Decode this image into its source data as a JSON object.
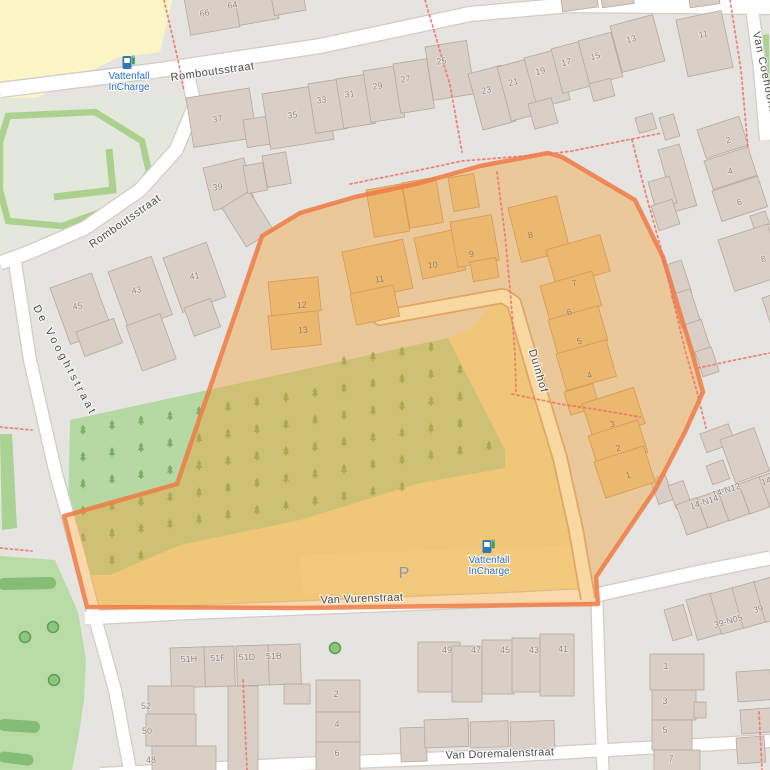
{
  "streets": [
    {
      "name": "Romboutsstraat",
      "x": 213,
      "y": 75,
      "rot": -8,
      "ls": 0.5
    },
    {
      "name": "Romboutsstraat",
      "x": 127,
      "y": 224,
      "rot": -35,
      "ls": 0.5
    },
    {
      "name": "De Vooghtstraat",
      "x": 62,
      "y": 362,
      "rot": 62,
      "ls": 3
    },
    {
      "name": "Van Vurenstraat",
      "x": 362,
      "y": 602,
      "rot": -2,
      "ls": 0.3
    },
    {
      "name": "Van Doremalenstraat",
      "x": 500,
      "y": 757,
      "rot": -2,
      "ls": 0.3
    },
    {
      "name": "Duinhof",
      "x": 535,
      "y": 372,
      "rot": 74,
      "ls": 1
    },
    {
      "name": "Van Coehoornstr",
      "x": 763,
      "y": 80,
      "rot": 78,
      "ls": 1
    }
  ],
  "house_numbers": [
    {
      "t": "66",
      "x": 205,
      "y": 16,
      "r": -10
    },
    {
      "t": "64",
      "x": 233,
      "y": 8,
      "r": -10
    },
    {
      "t": "37",
      "x": 218,
      "y": 122,
      "r": -9
    },
    {
      "t": "35",
      "x": 293,
      "y": 118,
      "r": -9
    },
    {
      "t": "33",
      "x": 322,
      "y": 103,
      "r": -9
    },
    {
      "t": "31",
      "x": 350,
      "y": 97,
      "r": -9
    },
    {
      "t": "29",
      "x": 378,
      "y": 89,
      "r": -9
    },
    {
      "t": "27",
      "x": 406,
      "y": 82,
      "r": -9
    },
    {
      "t": "25",
      "x": 442,
      "y": 64,
      "r": -9
    },
    {
      "t": "23",
      "x": 487,
      "y": 93,
      "r": -14
    },
    {
      "t": "21",
      "x": 514,
      "y": 85,
      "r": -14
    },
    {
      "t": "19",
      "x": 541,
      "y": 74,
      "r": -14
    },
    {
      "t": "17",
      "x": 567,
      "y": 65,
      "r": -14
    },
    {
      "t": "15",
      "x": 596,
      "y": 59,
      "r": -14
    },
    {
      "t": "13",
      "x": 632,
      "y": 42,
      "r": -14
    },
    {
      "t": "11",
      "x": 704,
      "y": 37,
      "r": -12
    },
    {
      "t": "39",
      "x": 218,
      "y": 190,
      "r": -8
    },
    {
      "t": "41",
      "x": 195,
      "y": 279,
      "r": -10
    },
    {
      "t": "43",
      "x": 137,
      "y": 293,
      "r": -10
    },
    {
      "t": "45",
      "x": 78,
      "y": 309,
      "r": -10
    },
    {
      "t": "2",
      "x": 729,
      "y": 143,
      "r": -15
    },
    {
      "t": "4",
      "x": 731,
      "y": 174,
      "r": -15
    },
    {
      "t": "6",
      "x": 740,
      "y": 205,
      "r": -15
    },
    {
      "t": "8",
      "x": 764,
      "y": 262,
      "r": -15
    },
    {
      "t": "14",
      "x": 767,
      "y": 484,
      "r": -18
    },
    {
      "t": "14-N12",
      "x": 727,
      "y": 493,
      "r": -18
    },
    {
      "t": "14-N14",
      "x": 705,
      "y": 505,
      "r": -18
    },
    {
      "t": "39",
      "x": 759,
      "y": 612,
      "r": -16
    },
    {
      "t": "39-N05",
      "x": 729,
      "y": 624,
      "r": -16
    },
    {
      "t": "1",
      "x": 666,
      "y": 669,
      "r": 0
    },
    {
      "t": "3",
      "x": 665,
      "y": 704,
      "r": 0
    },
    {
      "t": "5",
      "x": 665,
      "y": 733,
      "r": 0
    },
    {
      "t": "7",
      "x": 671,
      "y": 762,
      "r": 0
    },
    {
      "t": "49",
      "x": 447,
      "y": 653,
      "r": 0
    },
    {
      "t": "47",
      "x": 476,
      "y": 653,
      "r": 0
    },
    {
      "t": "45",
      "x": 505,
      "y": 653,
      "r": 0
    },
    {
      "t": "43",
      "x": 534,
      "y": 653,
      "r": 0
    },
    {
      "t": "41",
      "x": 563,
      "y": 652,
      "r": 0
    },
    {
      "t": "51H",
      "x": 189,
      "y": 662,
      "r": -2
    },
    {
      "t": "51F",
      "x": 218,
      "y": 661,
      "r": -2
    },
    {
      "t": "51D",
      "x": 247,
      "y": 660,
      "r": -2
    },
    {
      "t": "51B",
      "x": 274,
      "y": 659,
      "r": -2
    },
    {
      "t": "52",
      "x": 146,
      "y": 709,
      "r": 0
    },
    {
      "t": "50",
      "x": 147,
      "y": 734,
      "r": 0
    },
    {
      "t": "48",
      "x": 151,
      "y": 763,
      "r": 0
    },
    {
      "t": "2",
      "x": 336,
      "y": 697,
      "r": 0
    },
    {
      "t": "4",
      "x": 337,
      "y": 727,
      "r": 0
    },
    {
      "t": "6",
      "x": 337,
      "y": 756,
      "r": 0
    }
  ],
  "house_numbers_highlighted": [
    {
      "t": "8",
      "x": 531,
      "y": 238,
      "r": -12
    },
    {
      "t": "7",
      "x": 575,
      "y": 286,
      "r": -14
    },
    {
      "t": "6",
      "x": 570,
      "y": 315,
      "r": -14
    },
    {
      "t": "5",
      "x": 580,
      "y": 344,
      "r": -14
    },
    {
      "t": "4",
      "x": 590,
      "y": 378,
      "r": -14
    },
    {
      "t": "3",
      "x": 613,
      "y": 427,
      "r": -16
    },
    {
      "t": "2",
      "x": 619,
      "y": 451,
      "r": -16
    },
    {
      "t": "1",
      "x": 629,
      "y": 478,
      "r": -16
    },
    {
      "t": "9",
      "x": 472,
      "y": 257,
      "r": -10
    },
    {
      "t": "10",
      "x": 433,
      "y": 268,
      "r": -6
    },
    {
      "t": "11",
      "x": 380,
      "y": 282,
      "r": -8
    },
    {
      "t": "12",
      "x": 302,
      "y": 308,
      "r": -4
    },
    {
      "t": "13",
      "x": 303,
      "y": 333,
      "r": -4
    }
  ],
  "pois": [
    {
      "kind": "charging-station",
      "lines": [
        "Vattenfall",
        "InCharge"
      ],
      "x": 129,
      "y": 64
    },
    {
      "kind": "charging-station",
      "lines": [
        "Vattenfall",
        "InCharge"
      ],
      "x": 489,
      "y": 548
    },
    {
      "kind": "parking",
      "label": "P",
      "x": 404,
      "y": 578
    }
  ],
  "colors": {
    "highlight_fill": "#f39e30",
    "highlight_border": "#ee7b45",
    "poi_text": "#2a6fbf",
    "parking_text": "#8a96bf",
    "street_text": "#4c4c4c",
    "housenumber_text": "#93857a",
    "housenumber_highlight_text": "#9a7c4e",
    "boundary_dash": "#f0726a",
    "background": "#e6e4e1",
    "building": "#d9cfc7",
    "building_highlight": "#ecb76f",
    "green_area": "#b6d8a2",
    "grounds_yellow": "#efe3a9"
  }
}
